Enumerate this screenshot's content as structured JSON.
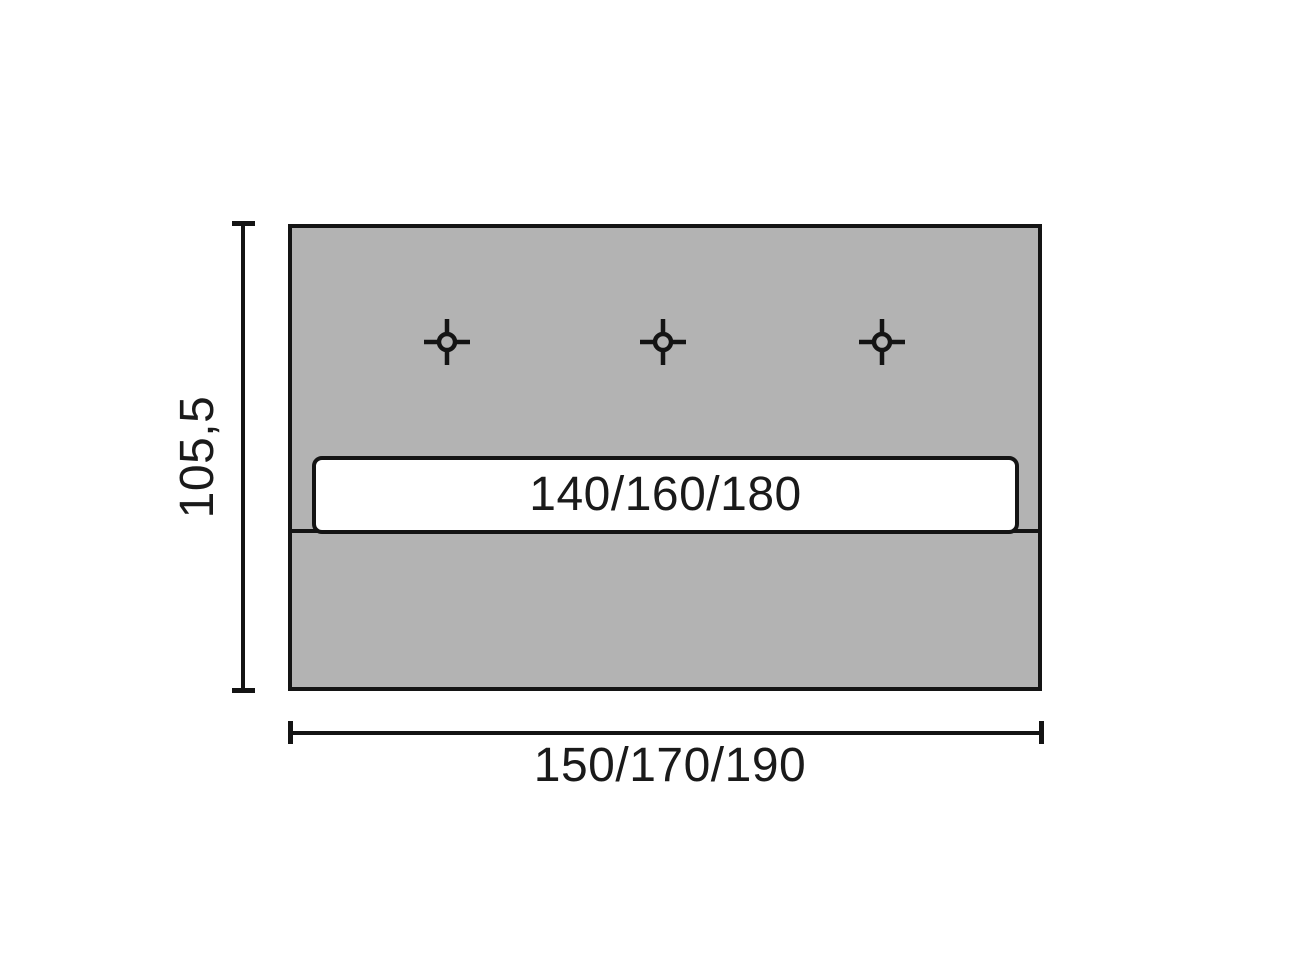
{
  "diagram": {
    "type": "furniture-dimension-drawing",
    "bar_label": "140/160/180",
    "height_dimension_label": "105,5",
    "width_dimension_label": "150/170/190",
    "drill_mark_count": 3,
    "drill_mark_icon": "crosshair-target",
    "colors": {
      "canvas_bg": "#ffffff",
      "panel_fill": "#b3b3b3",
      "outline": "#141414",
      "bar_fill": "#ffffff",
      "label_ink": "#1a1a1a"
    }
  }
}
